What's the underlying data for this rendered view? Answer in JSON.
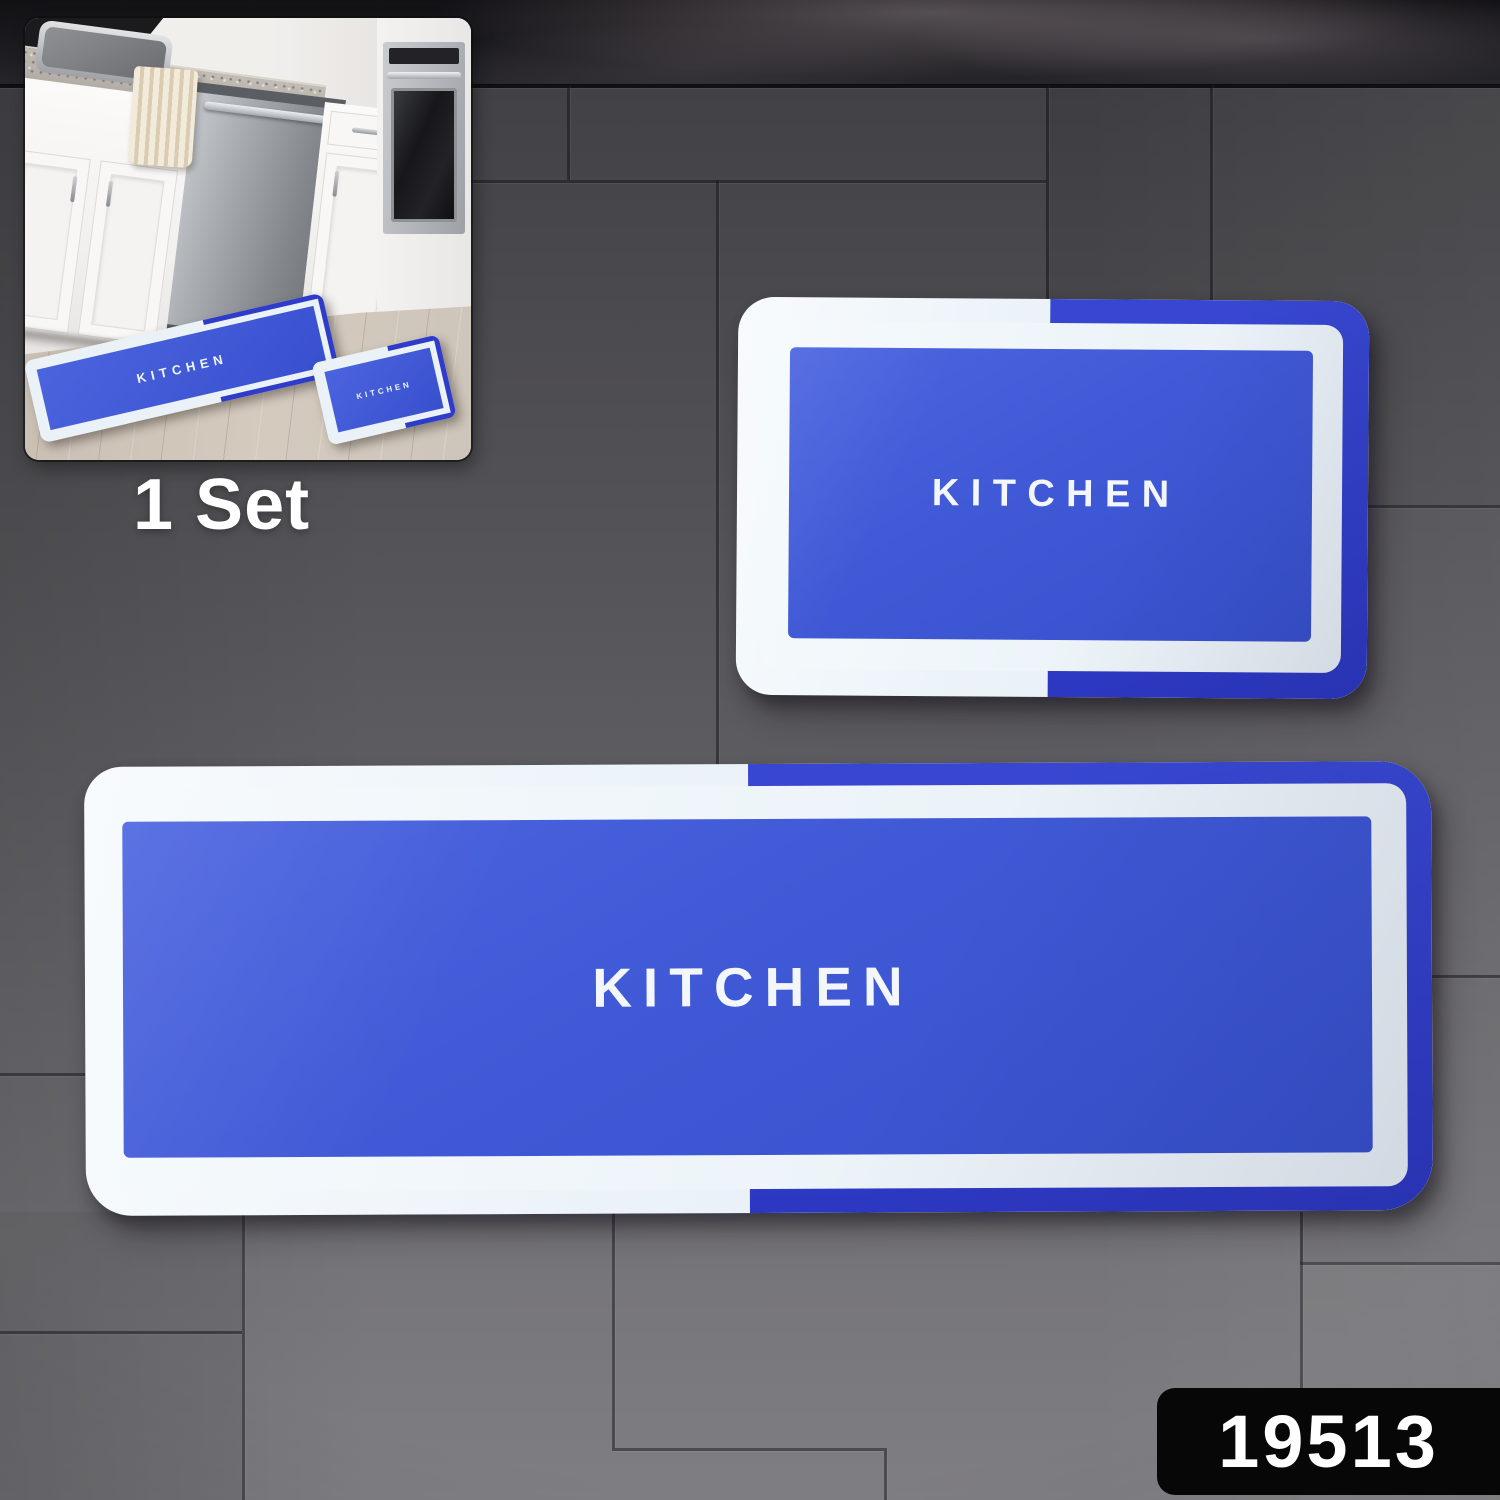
{
  "scene": {
    "set_label": "1 Set",
    "product_code": "19513"
  },
  "large_mat": {
    "label": "KITCHEN"
  },
  "small_mat": {
    "label": "KITCHEN"
  },
  "inset": {
    "runner_label": "KITCHEN",
    "small_label": "KITCHEN"
  },
  "colors": {
    "mat_inner_blue": "#3F59D5",
    "mat_dark_blue": "#2C38C6",
    "mat_border_white": "#EDF3F9",
    "tile_gray": "#5E5D61",
    "marble_dark": "#1C1B1F",
    "badge_bg": "#070708",
    "text_white": "#FFFFFF"
  }
}
